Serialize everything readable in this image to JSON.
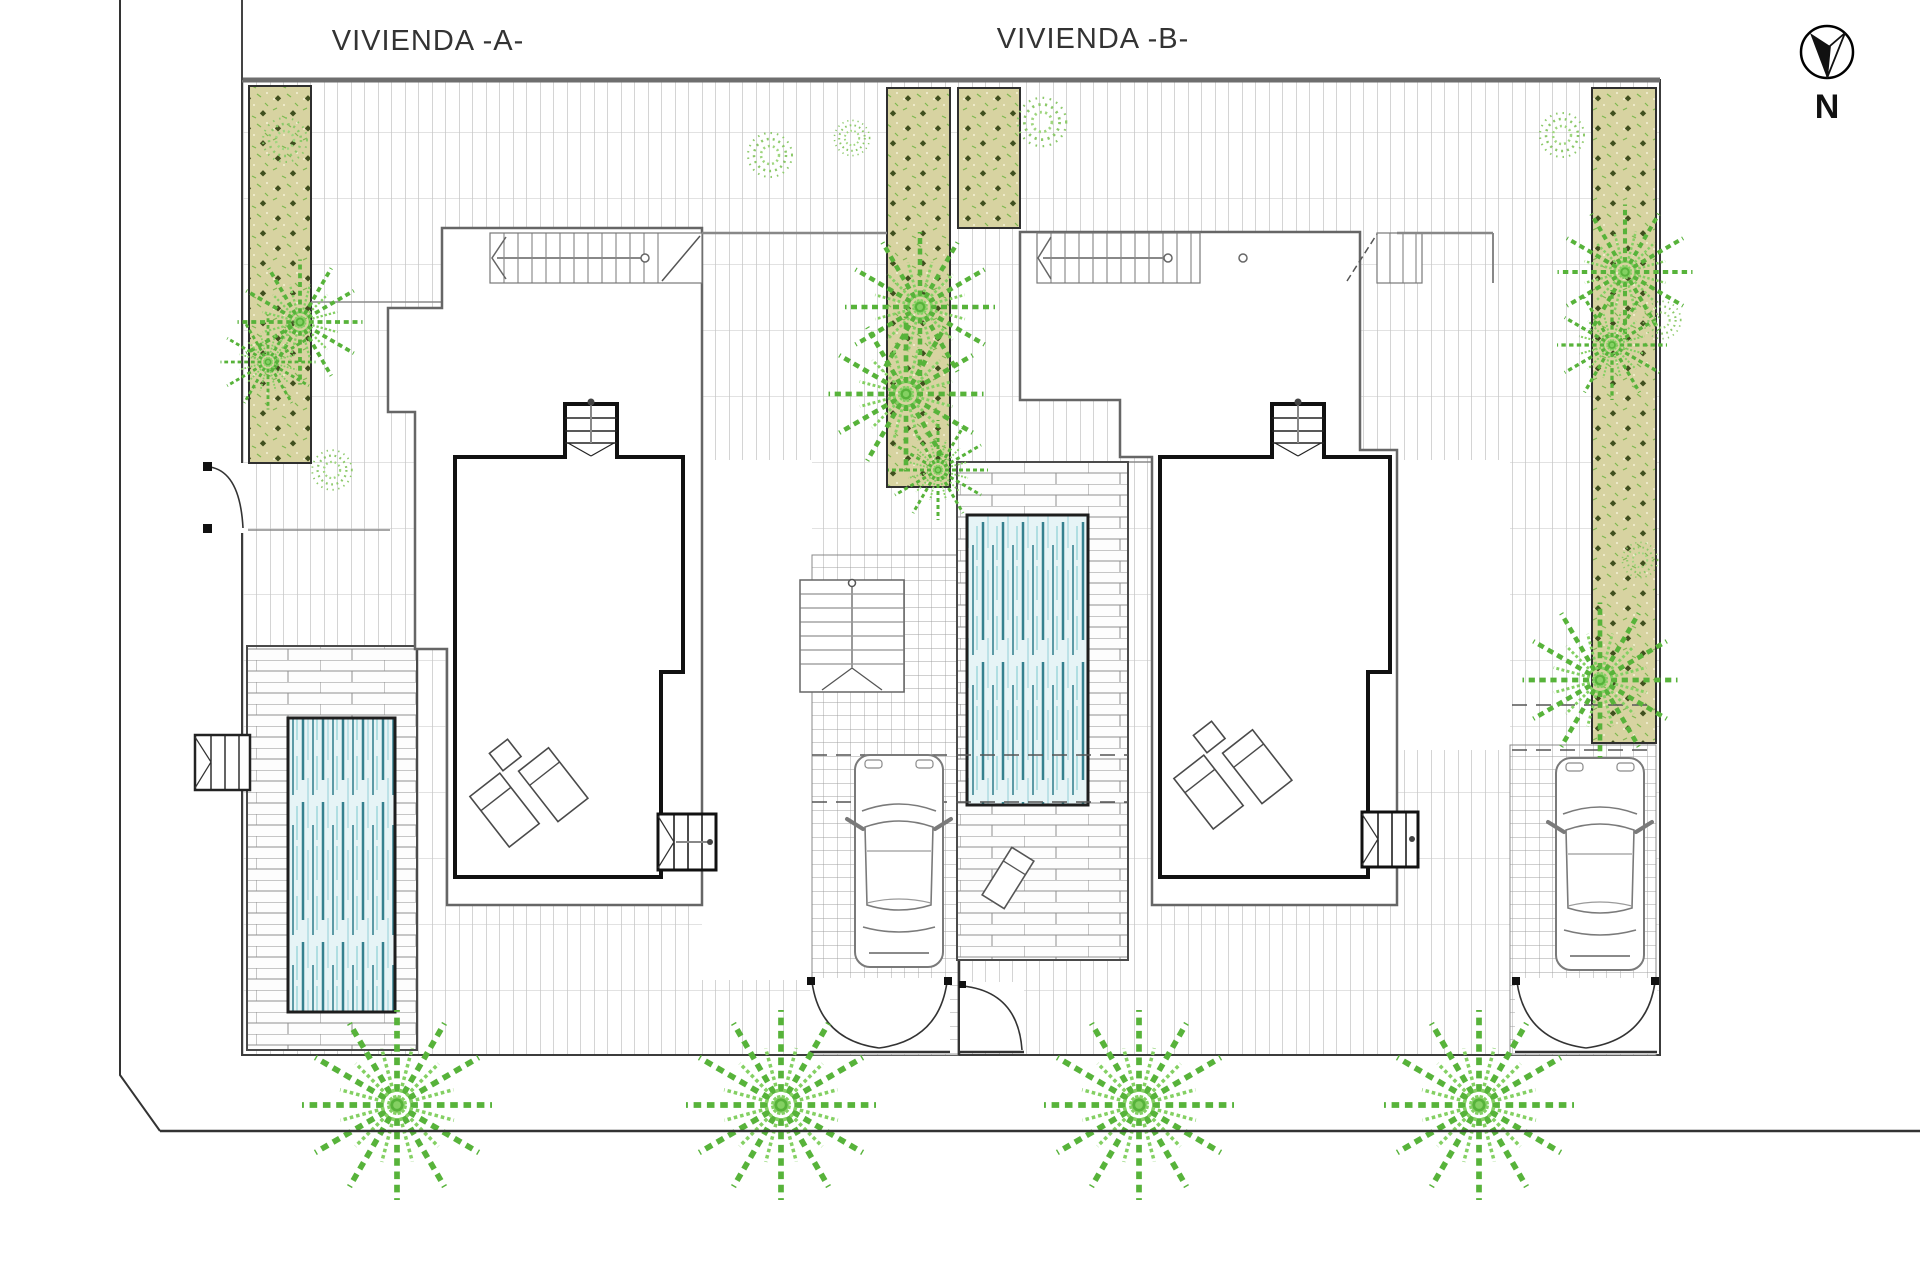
{
  "page": {
    "background": "#ffffff",
    "type": "architectural-site-plan"
  },
  "labels": {
    "house_a": "VIVIENDA -A-",
    "house_b": "VIVIENDA -B-",
    "north": "N"
  },
  "compass": {
    "icon": "north-arrow-icon",
    "direction": "N"
  },
  "palette": {
    "boundary_line": "#3c3c3c",
    "tile_joint": "#a8a8a8",
    "tile_course": "#c6c6c6",
    "planter_fill": "#d7d3a1",
    "planter_dot": "#3f4f1e",
    "plant_green": "#57b33a",
    "plant_green_light": "#84d063",
    "pool_water": "#e6f4f6",
    "pool_stripe_dark": "#35818f",
    "pool_stripe_light": "#bde2e7",
    "deck_line": "#8f8f8f",
    "wall_thick": "#111111",
    "roof_outline": "#666666"
  },
  "features": {
    "houses": 2,
    "pools": 2,
    "cars": 2,
    "street_palms": 4,
    "garden_palms": 8,
    "planted_strips": 4,
    "driveway_gates": 2,
    "pedestrian_gates": 2,
    "sun_loungers": 4,
    "stairs": 6
  }
}
